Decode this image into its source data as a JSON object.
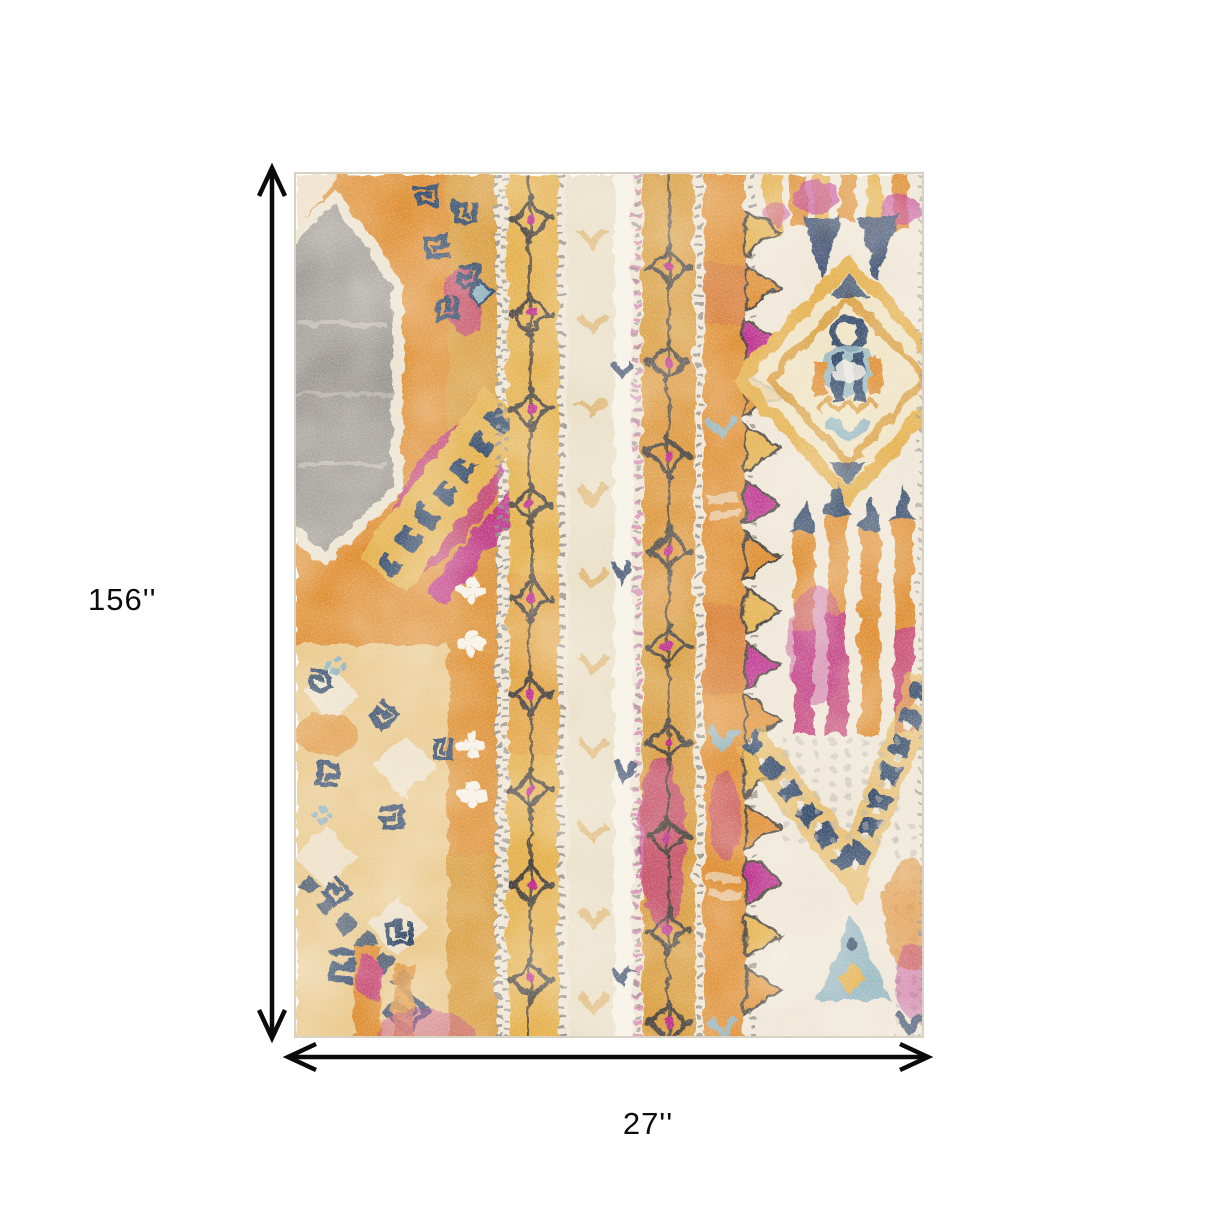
{
  "image": {
    "type": "product dimension illustration",
    "subject": "multicolor distressed bohemian tribal area rug"
  },
  "annotations": {
    "height_label": "156''",
    "width_label": "27''",
    "arrow_color": "#0b0b0b"
  },
  "rug": {
    "palette": {
      "cream": "#efe7d8",
      "eggshell": "#e9dfc8",
      "orange": "#df8e33",
      "rust": "#d4713a",
      "gold": "#e5b14e",
      "deepGold": "#d99c3c",
      "magenta": "#bb2a8c",
      "pink": "#d985b5",
      "navy": "#33486b",
      "lightBlue": "#8fb4c2",
      "gray": "#9c9894",
      "beadGray": "#8f8b85",
      "outline": "#47403a",
      "white": "#f7f3ea",
      "ink": "#0b0b0b",
      "edge": "#d8d2c4"
    }
  }
}
